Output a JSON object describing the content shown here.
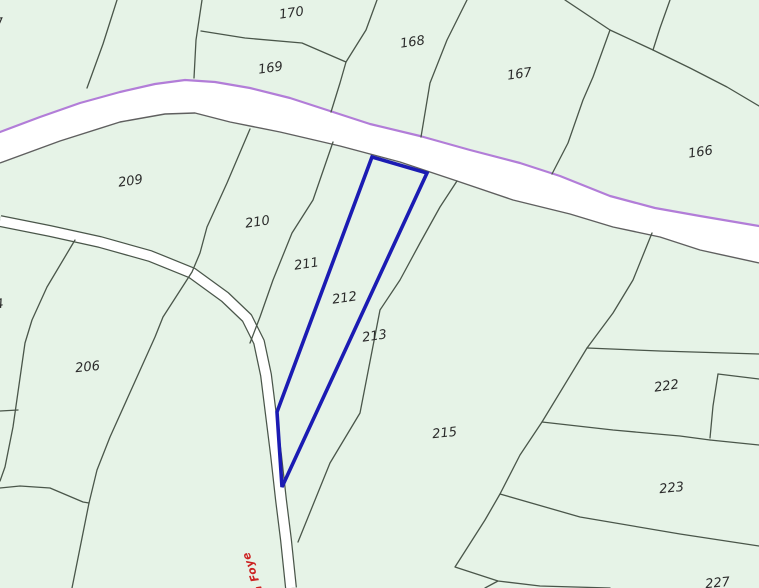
{
  "map": {
    "description": "Cadastral parcel map with one parcel highlighted",
    "highlighted_parcel": "212",
    "colors": {
      "background": "#e6f3e7",
      "parcel_line": "#4a564a",
      "road_fill": "#ffffff",
      "road_edge_purple": "#b27dd8",
      "road_edge_dark": "#5f5f5f",
      "highlight_blue": "#1b1bb3",
      "street_label_red": "#cc2222",
      "label_color": "#2b2b2b"
    },
    "parcels": [
      {
        "label": "7"
      },
      {
        "label": "170"
      },
      {
        "label": "169"
      },
      {
        "label": "168"
      },
      {
        "label": "167"
      },
      {
        "label": "166"
      },
      {
        "label": "209"
      },
      {
        "label": "210"
      },
      {
        "label": "211"
      },
      {
        "label": "212"
      },
      {
        "label": "213"
      },
      {
        "label": "206"
      },
      {
        "label": "215"
      },
      {
        "label": "222"
      },
      {
        "label": "223"
      },
      {
        "label": "227"
      },
      {
        "label": "4"
      }
    ],
    "street_label": {
      "text": "a Foye"
    }
  }
}
